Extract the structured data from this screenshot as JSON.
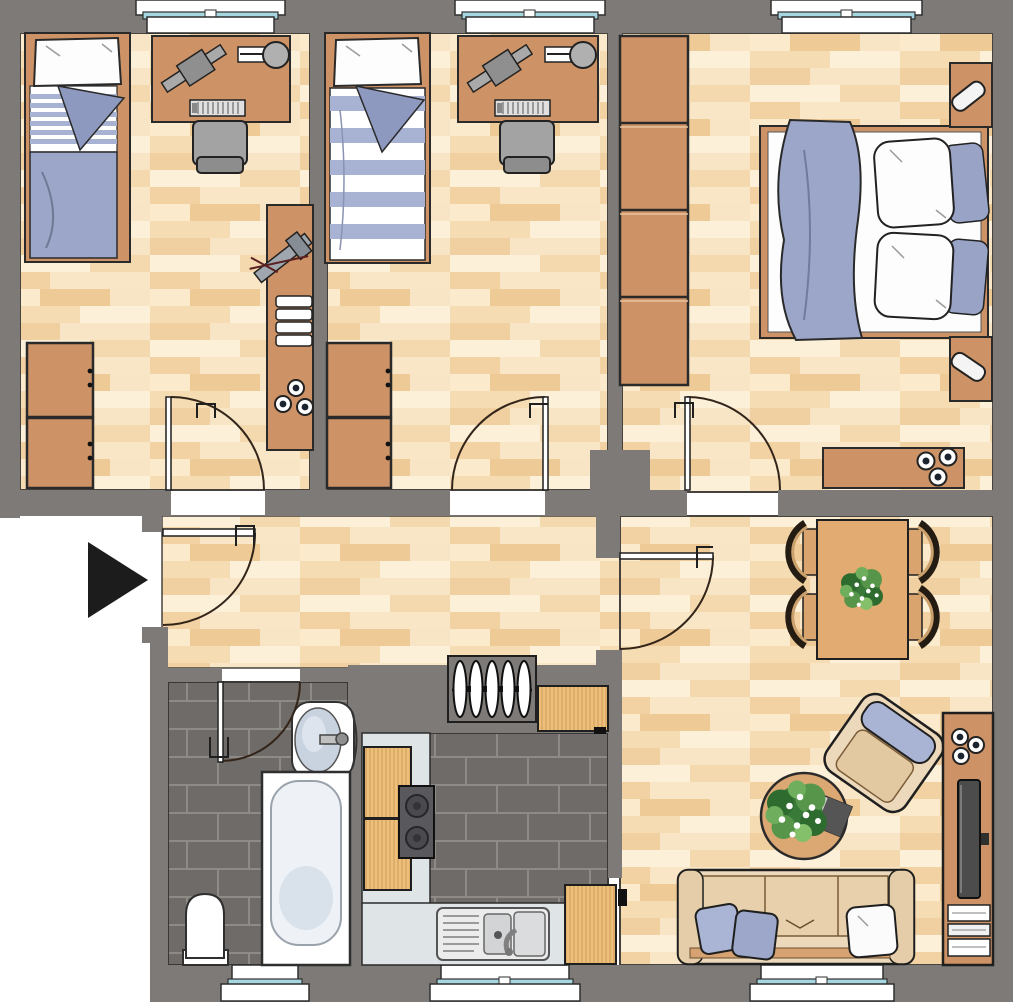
{
  "title": "Apartment floor plan, top-down architectural drawing with furniture",
  "floorplan": {
    "entrance_marker": "black-arrow-pointing-right",
    "colors": {
      "wall": "#7d7a77",
      "outline": "#1f1f1f",
      "door_arc": "#33251a",
      "floor_wood_base": "#f8e5c5",
      "floor_wood_light": "#fdf0d9",
      "floor_wood_dark": "#eeca97",
      "furniture_wood": "#cd9366",
      "cabinet_wood_light": "#ecc07c",
      "cabinet_wood_grain": "#d9a75f",
      "dining_wood": "#e2ab72",
      "kitchen_counter": "#dfe4e7",
      "tile_dark": "#6f6b68",
      "tile_grout": "#8e8a86",
      "fabric_blue": "#9ba6c9",
      "fabric_blue_stripe": "#a8b2d2",
      "pillow_white": "#fdfdfd",
      "window_glass": "#a6d7e0",
      "sofa_tan": "#ecd8ba",
      "armchair_cushion": "#a9b3d3",
      "stove_gray": "#59585c",
      "chair_gray": "#a3a3a3",
      "tub_inner": "#eef2f7",
      "plant_green": "#3a7a39",
      "arrow_black": "#1c1c1c"
    },
    "windows": {
      "top_count": 3,
      "bottom_count": 3,
      "style": "white-sill-teal-glass"
    },
    "rooms": [
      {
        "id": "bedroom-1",
        "position": "top-left",
        "furniture": [
          "single-bed-striped-blue-duvet",
          "desk",
          "desk-lamp",
          "keyboard",
          "desk-chair",
          "shelf-unit",
          "exercise-equipment",
          "towel-stack",
          "three-bowls",
          "cabinet-upper",
          "cabinet-lower",
          "door-swing"
        ]
      },
      {
        "id": "bedroom-2",
        "position": "top-middle",
        "furniture": [
          "single-bed-striped-duvet",
          "desk",
          "desk-lamp",
          "keyboard",
          "desk-chair",
          "cabinet-upper",
          "cabinet-lower",
          "door-swing"
        ]
      },
      {
        "id": "master-bedroom",
        "position": "top-right",
        "furniture": [
          "wardrobe-4-door",
          "double-bed",
          "blue-duvet",
          "two-white-pillows",
          "two-blue-pillows",
          "nightstand-with-lamp-top",
          "nightstand-with-lamp-bottom",
          "sideboard-with-bowls",
          "door-swing"
        ]
      },
      {
        "id": "hallway",
        "position": "center",
        "furniture": [
          "entrance-door-swing",
          "entrance-arrow",
          "radiator-5-fins",
          "door-to-living-swing"
        ]
      },
      {
        "id": "bathroom",
        "position": "bottom-left",
        "furniture": [
          "door-swing",
          "washbasin-with-faucet",
          "bathtub",
          "toilet",
          "window"
        ]
      },
      {
        "id": "kitchen",
        "position": "bottom-middle",
        "furniture": [
          "l-shaped-counter",
          "wood-cabinet",
          "wood-cabinet",
          "stove-two-burners",
          "double-sink-with-drainboard",
          "corner-cabinet-top-right",
          "corner-cabinet-bottom-right",
          "window"
        ]
      },
      {
        "id": "living-dining-room",
        "position": "right",
        "furniture": [
          "dining-table",
          "plant-centerpiece",
          "four-dining-chairs",
          "sofa-three-seat",
          "two-blue-cushions",
          "white-cushion",
          "round-coffee-table",
          "plant",
          "magazine",
          "armchair-rotated",
          "tv-sideboard",
          "three-bowls",
          "tv",
          "hifi-stack",
          "window"
        ]
      }
    ]
  }
}
